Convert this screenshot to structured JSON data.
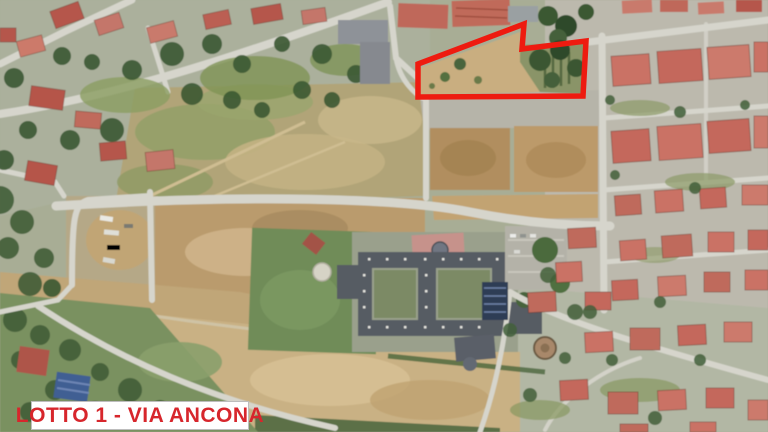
{
  "annotation": {
    "label_text": "LOTTO 1 - VIA ANCONA",
    "label_text_color": "#d7262c",
    "label_background": "#ffffff",
    "label_border_color": "#bdbdbd",
    "outline_color": "#ee1b10",
    "outline_width_px": 5.5,
    "lot_polygon_points": "418,64 524,24 522,49 586,41 583,96 418,97"
  },
  "map": {
    "type": "aerial-photo",
    "palette": {
      "road": "#d6d5cc",
      "rooftop_red": "#c47062",
      "tree_green": "#3b5833",
      "field_green": "#7a9161",
      "bare_soil": "#ba9b6d",
      "scrubland": "#b1a478",
      "building_complex_roof": "#565b63"
    }
  }
}
